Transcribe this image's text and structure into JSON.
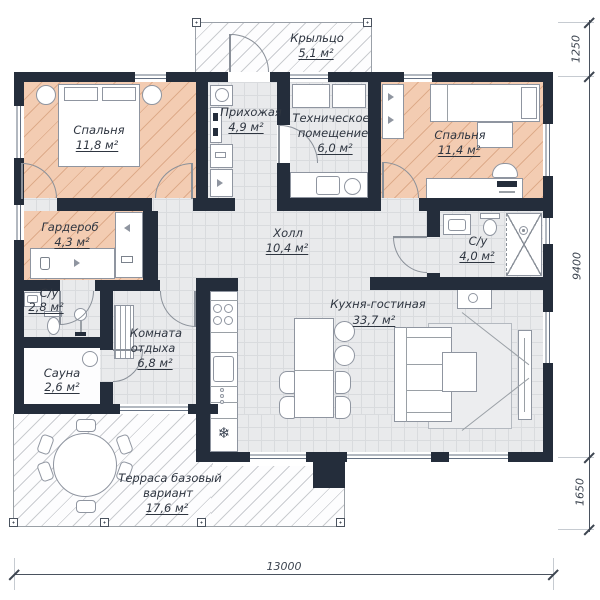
{
  "plan": {
    "type": "floor-plan",
    "language": "ru",
    "rooms": [
      {
        "id": "porch",
        "lines": [
          "Крыльцо"
        ],
        "area": "5,1 м²"
      },
      {
        "id": "bedroom-left",
        "lines": [
          "Спальня"
        ],
        "area": "11,8 м²"
      },
      {
        "id": "entry",
        "lines": [
          "Прихожая"
        ],
        "area": "4,9 м²"
      },
      {
        "id": "tech-room",
        "lines": [
          "Техническое",
          "помещение"
        ],
        "area": "6,0 м²"
      },
      {
        "id": "bedroom-right",
        "lines": [
          "Спальня"
        ],
        "area": "11,4 м²"
      },
      {
        "id": "wardrobe",
        "lines": [
          "Гардероб"
        ],
        "area": "4,3 м²"
      },
      {
        "id": "hall",
        "lines": [
          "Холл"
        ],
        "area": "10,4 м²"
      },
      {
        "id": "bathroom-right",
        "lines": [
          "С/у"
        ],
        "area": "4,0 м²"
      },
      {
        "id": "bathroom-left",
        "lines": [
          "С/у"
        ],
        "area": "2,8 м²"
      },
      {
        "id": "lounge",
        "lines": [
          "Комната",
          "отдыха"
        ],
        "area": "6,8 м²"
      },
      {
        "id": "sauna",
        "lines": [
          "Сауна"
        ],
        "area": "2,6 м²"
      },
      {
        "id": "kitchen-living",
        "lines": [
          "Кухня-гостиная"
        ],
        "area": "33,7 м²"
      },
      {
        "id": "terrace",
        "lines": [
          "Терраса базовый",
          "вариант"
        ],
        "area": "17,6 м²"
      }
    ],
    "dimensions": {
      "bottom": "13000",
      "right_top": "1250",
      "right_middle": "9400",
      "right_bottom": "1650"
    },
    "icons": {
      "snowflake": "❄"
    },
    "colors": {
      "wall": "#242d3b",
      "bedroom_floor": "#f3ccb2",
      "floor_grid": "#e9eaec",
      "hatch_line": "#8e959e",
      "dimension": "#3d4550"
    }
  }
}
